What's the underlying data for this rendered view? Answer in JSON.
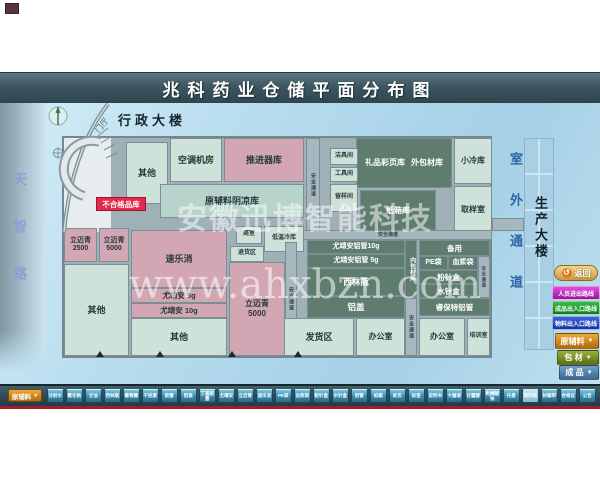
{
  "colors": {
    "title_bar": "#3c5761",
    "map_blue": "#b7dcee",
    "room_green": "#cfe2da",
    "room_pink": "#d2a6b2",
    "room_dark_green": "#5e7d6f",
    "corridor_gray": "#a6b8be",
    "alert_red": "#e42a4c",
    "bottom_bar": "#2e4a55",
    "accent_line_red": "#a51d2d"
  },
  "header": {
    "title": "兆科药业仓储平面分布图"
  },
  "surroundings": {
    "west_road": "天智路",
    "east_passage": "室外通道",
    "admin_building": "行政大楼",
    "production_building": "生产大楼",
    "lobby": "门厅"
  },
  "labels": {
    "safety_corridor": "安全通道",
    "unqualified_store": "不合格品库"
  },
  "rooms": {
    "other_top": {
      "label": "其他"
    },
    "hvac": {
      "label": "空调机房"
    },
    "propeller": {
      "label": "推进器库"
    },
    "raw_material_cool": {
      "label": "原辅料阴凉库"
    },
    "cleaning_tools": {
      "label": "洁具间"
    },
    "tools": {
      "label": "工具间"
    },
    "sample_keep": {
      "label": "留样间"
    },
    "gift_brochure": {
      "label": "礼品彩页库"
    },
    "outer_packaging": {
      "label": "外包材库"
    },
    "carton": {
      "label": "纸箱库"
    },
    "small_cold": {
      "label": "小冷库"
    },
    "sampling": {
      "label": "取样室"
    },
    "limaiqing_2500": {
      "label": "立迈青",
      "sub": "2500"
    },
    "limaiqing_5000_small": {
      "label": "立迈青",
      "sub": "5000"
    },
    "sulexiao": {
      "label": "速乐消"
    },
    "youjingan_5g": {
      "label": "尤靖安 5g"
    },
    "youjingan_10g": {
      "label": "尤靖安 10g"
    },
    "other_left": {
      "label": "其他"
    },
    "other_bottom": {
      "label": "其他"
    },
    "office_small": {
      "label": "商室"
    },
    "low_temp_cold": {
      "label": "低温冷库"
    },
    "returns": {
      "label": "退货区"
    },
    "limaiqing_5000_big": {
      "label": "立迈青",
      "sub": "5000"
    },
    "yja_tube_10g": {
      "label": "尤靖安铝管10g"
    },
    "yja_tube_5g": {
      "label": "尤靖安铝管 5g"
    },
    "vials": {
      "label": "西林瓶"
    },
    "alu_caps": {
      "label": "铝盖"
    },
    "inner_packaging": {
      "label": "内包材库"
    },
    "spare": {
      "label": "备用"
    },
    "pe_bags": {
      "label": "PE袋"
    },
    "plasma_bags": {
      "label": "血浆袋"
    },
    "powder_inj_box": {
      "label": "粉针盒"
    },
    "water_inj_box": {
      "label": "水针盒"
    },
    "ruibaote_tube": {
      "label": "睿保特铝管"
    },
    "shipping": {
      "label": "发货区"
    },
    "office_1": {
      "label": "办公室"
    },
    "office_2": {
      "label": "办公室"
    },
    "training": {
      "label": "培训室"
    }
  },
  "watermark": {
    "line1": "安徽迅博智能科技",
    "line2": "www.ahxbzn.com"
  },
  "panel": {
    "back_label": "返回",
    "routes": [
      {
        "label": "人员进出路线"
      },
      {
        "label": "成品出入口路线"
      },
      {
        "label": "物料出入口路线"
      }
    ],
    "dropdowns": [
      {
        "label": "原辅料"
      },
      {
        "label": "包 材"
      },
      {
        "label": "成 品"
      }
    ]
  },
  "bottom_bar": {
    "dropdown": "原辅料",
    "items": [
      "注射水",
      "氯化钠",
      "甘油",
      "西林瓶",
      "葡萄糖",
      "干扰素",
      "胶塞",
      "铝盖",
      "丁基胶塞",
      "尤靖安",
      "立迈青",
      "速乐消",
      "PE袋",
      "血浆袋",
      "粉针盒",
      "水针盒",
      "铝管",
      "纸箱",
      "彩页",
      "标签",
      "说明书",
      "大输液",
      "甘露醇",
      "枸橼酸钠",
      "托盘",
      "周转箱",
      "封箱带",
      "合格证",
      "公告"
    ]
  }
}
